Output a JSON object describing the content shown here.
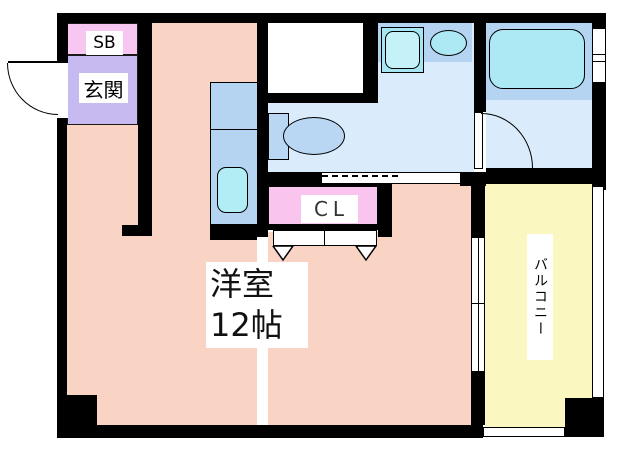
{
  "floor_plan": {
    "labels": {
      "shoe_box": "SB",
      "entrance": "玄関",
      "closet": "CL",
      "room_name": "洋室",
      "room_size": "12帖",
      "balcony": "バルコニー"
    },
    "colors": {
      "wall": "#000000",
      "western_room_floor": "#f9d3c4",
      "entrance_floor": "#c7baf0",
      "shoe_box_fill": "#f7c7f2",
      "closet_fill": "#f9c4ed",
      "sanitary_floor": "#daecfb",
      "counter_blue": "#b5d4f2",
      "fixture_cyan": "#ace9f4",
      "toilet_fill": "#b9d6f2",
      "balcony_floor": "#faf7c1",
      "door_window_white": "#ffffff"
    }
  }
}
